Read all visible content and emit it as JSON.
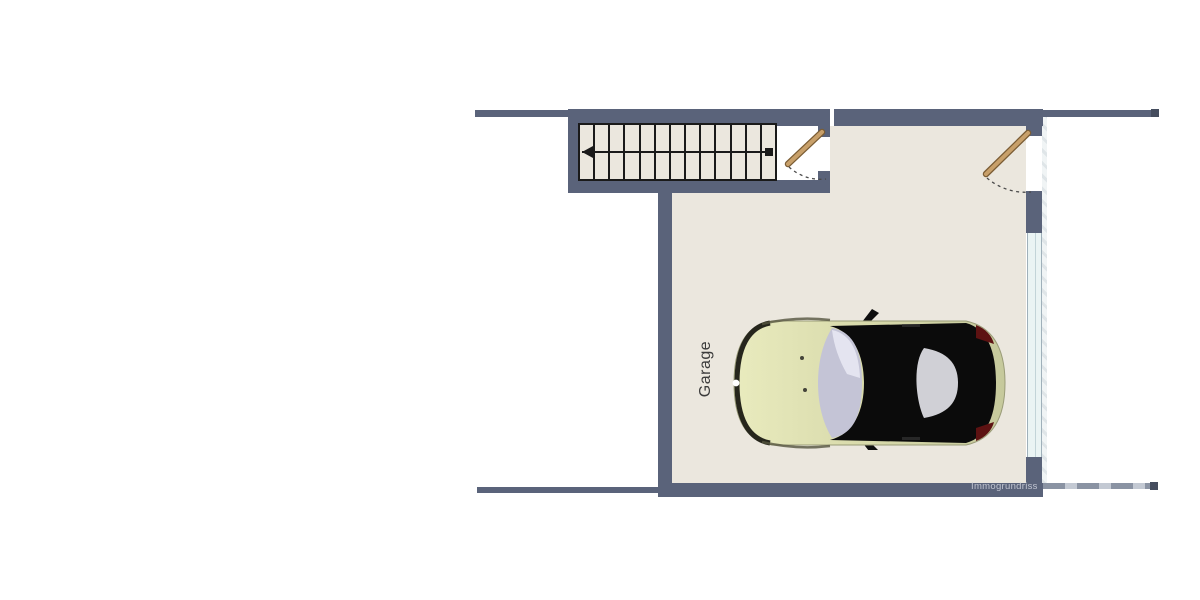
{
  "plan": {
    "room_label": "Garage",
    "watermark": "Immogrundriss",
    "staircase": {
      "treads": 13,
      "direction": "left"
    },
    "doors": [
      {
        "id": "stair-door",
        "leaf": "tan",
        "swing": "quarter-arc-dashed"
      },
      {
        "id": "entry-door",
        "leaf": "tan",
        "swing": "quarter-arc-dashed"
      }
    ],
    "window": {
      "side": "right-wall"
    },
    "car": {
      "view": "top",
      "facing": "left"
    }
  },
  "colors": {
    "wall": "#5a637a",
    "floor": "#ebe7de",
    "stair-line": "#1a1a1a",
    "window-glass": "#eaf4f4",
    "window-frame": "#9fb0ba",
    "door-leaf": "#c8a06a",
    "door-leaf-edge": "#7a5c34",
    "swing-arc": "#4a4a4a",
    "car-body": "#d9dbac",
    "car-roof": "#0b0b0b",
    "car-glass": "#c4c4d6",
    "car-taillight": "#5d1212",
    "label-text": "#3b3b3b",
    "watermark-text": "#c2c6d2"
  }
}
